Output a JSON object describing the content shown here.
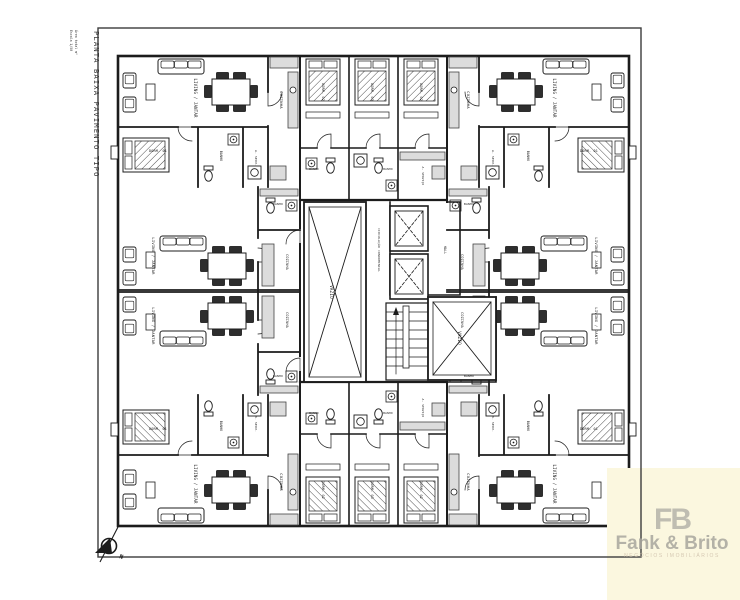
{
  "sheet": {
    "title": "PLANTA BAIXA PAVIMENTO TIPO",
    "scale_note": "Escala 1/50",
    "area_note": "Área total m²",
    "compass_label": "N"
  },
  "watermark": {
    "monogram": "FB",
    "name": "Fank & Brito",
    "tagline": "NEGÓCIOS IMOBILIÁRIOS",
    "background": "#FBF7DF",
    "text_color": "#A8A69E"
  },
  "colors": {
    "paper": "#FFFFFF",
    "line": "#1C1C1C",
    "counter_fill": "#DCDCDC",
    "chair_fill": "#2E2E2E"
  },
  "plan": {
    "labels": [
      {
        "t": "LIVING / JANTAR",
        "x": 194,
        "y": 98,
        "r": 90,
        "s": 4
      },
      {
        "t": "COZINHA",
        "x": 280,
        "y": 100,
        "r": 90,
        "s": 3.8
      },
      {
        "t": "DORM. 01",
        "x": 158,
        "y": 152,
        "r": 0,
        "s": 3.4
      },
      {
        "t": "BANHO",
        "x": 220,
        "y": 156,
        "r": 90,
        "s": 3.2
      },
      {
        "t": "A. SERV.",
        "x": 255,
        "y": 158,
        "r": 90,
        "s": 3.0
      },
      {
        "t": "LIVING / JANTAR",
        "x": 553,
        "y": 98,
        "r": 90,
        "s": 4
      },
      {
        "t": "COZINHA",
        "x": 467,
        "y": 100,
        "r": 90,
        "s": 3.8
      },
      {
        "t": "DORM. 01",
        "x": 589,
        "y": 152,
        "r": 0,
        "s": 3.4
      },
      {
        "t": "BANHO",
        "x": 527,
        "y": 156,
        "r": 90,
        "s": 3.2
      },
      {
        "t": "A. SERV.",
        "x": 492,
        "y": 158,
        "r": 90,
        "s": 3.0
      },
      {
        "t": "LIVING / JANTAR",
        "x": 194,
        "y": 484,
        "r": 90,
        "s": 4
      },
      {
        "t": "COZINHA",
        "x": 280,
        "y": 482,
        "r": 90,
        "s": 3.8
      },
      {
        "t": "DORM. 01",
        "x": 158,
        "y": 430,
        "r": 0,
        "s": 3.4
      },
      {
        "t": "BANHO",
        "x": 220,
        "y": 426,
        "r": 90,
        "s": 3.2
      },
      {
        "t": "A. SERV.",
        "x": 255,
        "y": 424,
        "r": 90,
        "s": 3.0
      },
      {
        "t": "LIVING / JANTAR",
        "x": 553,
        "y": 484,
        "r": 90,
        "s": 4
      },
      {
        "t": "COZINHA",
        "x": 467,
        "y": 482,
        "r": 90,
        "s": 3.8
      },
      {
        "t": "DORM. 01",
        "x": 589,
        "y": 430,
        "r": 0,
        "s": 3.4
      },
      {
        "t": "BANHO",
        "x": 527,
        "y": 426,
        "r": 90,
        "s": 3.2
      },
      {
        "t": "A. SERV.",
        "x": 492,
        "y": 424,
        "r": 90,
        "s": 3.0
      },
      {
        "t": "LIVING / JANTAR",
        "x": 152,
        "y": 256,
        "r": 90,
        "s": 3.8
      },
      {
        "t": "COZINHA",
        "x": 286,
        "y": 262,
        "r": 90,
        "s": 3.4
      },
      {
        "t": "BANHO",
        "x": 278,
        "y": 205,
        "r": 0,
        "s": 3
      },
      {
        "t": "LIVING / JANTAR",
        "x": 152,
        "y": 326,
        "r": 90,
        "s": 3.8
      },
      {
        "t": "COZINHA",
        "x": 286,
        "y": 320,
        "r": 90,
        "s": 3.4
      },
      {
        "t": "BANHO",
        "x": 278,
        "y": 377,
        "r": 0,
        "s": 3
      },
      {
        "t": "LIVING / JANTAR",
        "x": 595,
        "y": 256,
        "r": 90,
        "s": 3.8
      },
      {
        "t": "COZINHA",
        "x": 461,
        "y": 262,
        "r": 90,
        "s": 3.4
      },
      {
        "t": "BANHO",
        "x": 469,
        "y": 205,
        "r": 0,
        "s": 3
      },
      {
        "t": "LIVING / JANTAR",
        "x": 595,
        "y": 326,
        "r": 90,
        "s": 3.8
      },
      {
        "t": "COZINHA",
        "x": 461,
        "y": 320,
        "r": 90,
        "s": 3.4
      },
      {
        "t": "BANHO",
        "x": 469,
        "y": 377,
        "r": 0,
        "s": 3
      },
      {
        "t": "DORM. 02",
        "x": 322,
        "y": 92,
        "r": 90,
        "s": 3.4
      },
      {
        "t": "DORM. 03",
        "x": 371,
        "y": 92,
        "r": 90,
        "s": 3.4
      },
      {
        "t": "DORM. 02",
        "x": 420,
        "y": 92,
        "r": 90,
        "s": 3.4
      },
      {
        "t": "DORM. 02",
        "x": 322,
        "y": 490,
        "r": 90,
        "s": 3.4
      },
      {
        "t": "DORM. 03",
        "x": 371,
        "y": 490,
        "r": 90,
        "s": 3.4
      },
      {
        "t": "DORM. 02",
        "x": 420,
        "y": 490,
        "r": 90,
        "s": 3.4
      },
      {
        "t": "BANHO",
        "x": 314,
        "y": 170,
        "r": 0,
        "s": 2.8
      },
      {
        "t": "BANHO",
        "x": 388,
        "y": 170,
        "r": 0,
        "s": 2.8
      },
      {
        "t": "A. SERVIÇO",
        "x": 422,
        "y": 176,
        "r": 90,
        "s": 2.8
      },
      {
        "t": "BANHO",
        "x": 314,
        "y": 414,
        "r": 0,
        "s": 2.8
      },
      {
        "t": "BANHO",
        "x": 388,
        "y": 414,
        "r": 0,
        "s": 2.8
      },
      {
        "t": "A. SERVIÇO",
        "x": 422,
        "y": 408,
        "r": 90,
        "s": 2.8
      },
      {
        "t": "VAZIO",
        "x": 330,
        "y": 292,
        "r": 90,
        "s": 4.2
      },
      {
        "t": "VAZIO",
        "x": 458,
        "y": 338,
        "r": 90,
        "s": 4.2
      },
      {
        "t": "CIRCULAÇÃO CONDOMINIAL",
        "x": 378,
        "y": 250,
        "r": 90,
        "s": 3
      },
      {
        "t": "HALL",
        "x": 444,
        "y": 250,
        "r": 90,
        "s": 3.2
      }
    ]
  }
}
